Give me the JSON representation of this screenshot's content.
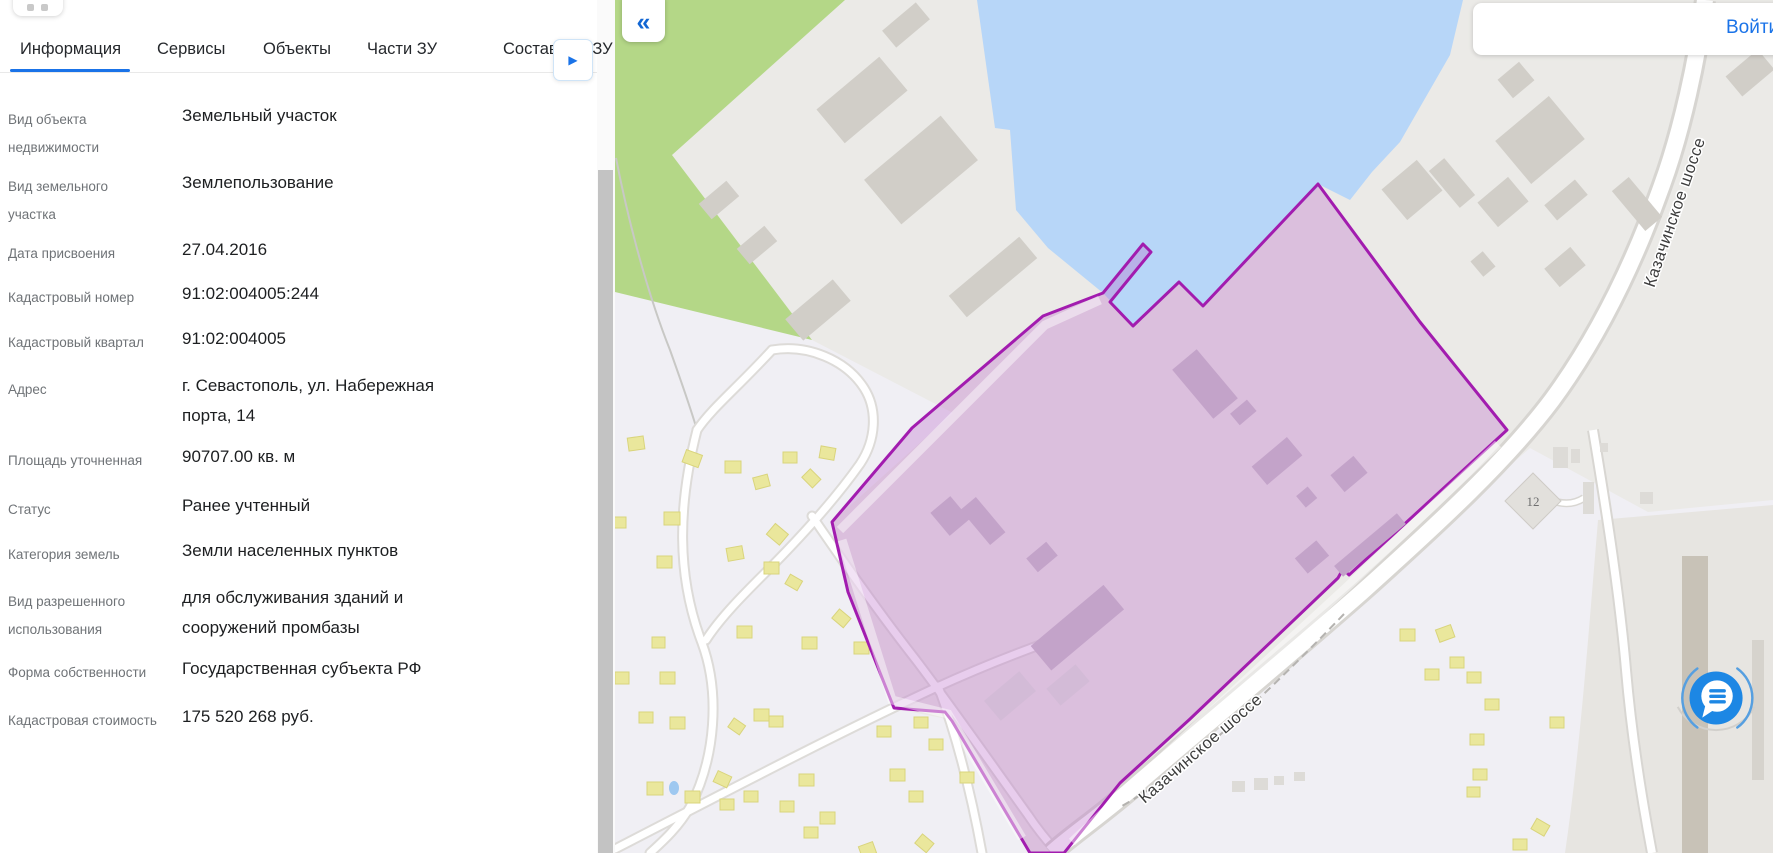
{
  "panel": {
    "tabs": [
      {
        "label": "Информация",
        "active": true
      },
      {
        "label": "Сервисы",
        "active": false
      },
      {
        "label": "Объекты",
        "active": false
      },
      {
        "label": "Части ЗУ",
        "active": false
      },
      {
        "label": "Составные ЗУ",
        "active": false
      }
    ],
    "fields": [
      {
        "label": "Вид объекта недвижимости",
        "value": "Земельный участок"
      },
      {
        "label": "Вид земельного участка",
        "value": "Землепользование"
      },
      {
        "label": "Дата присвоения",
        "value": "27.04.2016"
      },
      {
        "label": "Кадастровый номер",
        "value": "91:02:004005:244"
      },
      {
        "label": "Кадастровый квартал",
        "value": "91:02:004005"
      },
      {
        "label": "Адрес",
        "value": "г. Севастополь, ул. Набережная порта, 14"
      },
      {
        "label": "Площадь уточненная",
        "value": "90707.00 кв. м"
      },
      {
        "label": "Статус",
        "value": "Ранее учтенный"
      },
      {
        "label": "Категория земель",
        "value": "Земли населенных пунктов"
      },
      {
        "label": "Вид разрешенного использования",
        "value": "для обслуживания зданий и сооружений промбазы"
      },
      {
        "label": "Форма собственности",
        "value": "Государственная субъекта РФ"
      },
      {
        "label": "Кадастровая стоимость",
        "value": "175 520 268 руб."
      }
    ]
  },
  "map": {
    "road_labels": [
      "Казачинское шоссе",
      "Казачинское  шоссе"
    ],
    "building_label": "12",
    "login_label": "Войти"
  },
  "icons": {
    "collapse": "«",
    "tab_scroll": "▶"
  },
  "colors": {
    "accent_blue": "#1a73e8",
    "parcel_border": "#a21caf",
    "parcel_fill": "rgba(187,107,203,0.34)",
    "water": "#b7d6f8",
    "green": "#b4d787",
    "industrial": "#ebeae7",
    "residential": "#f0eff4",
    "chat_blue": "#1d87e4"
  }
}
